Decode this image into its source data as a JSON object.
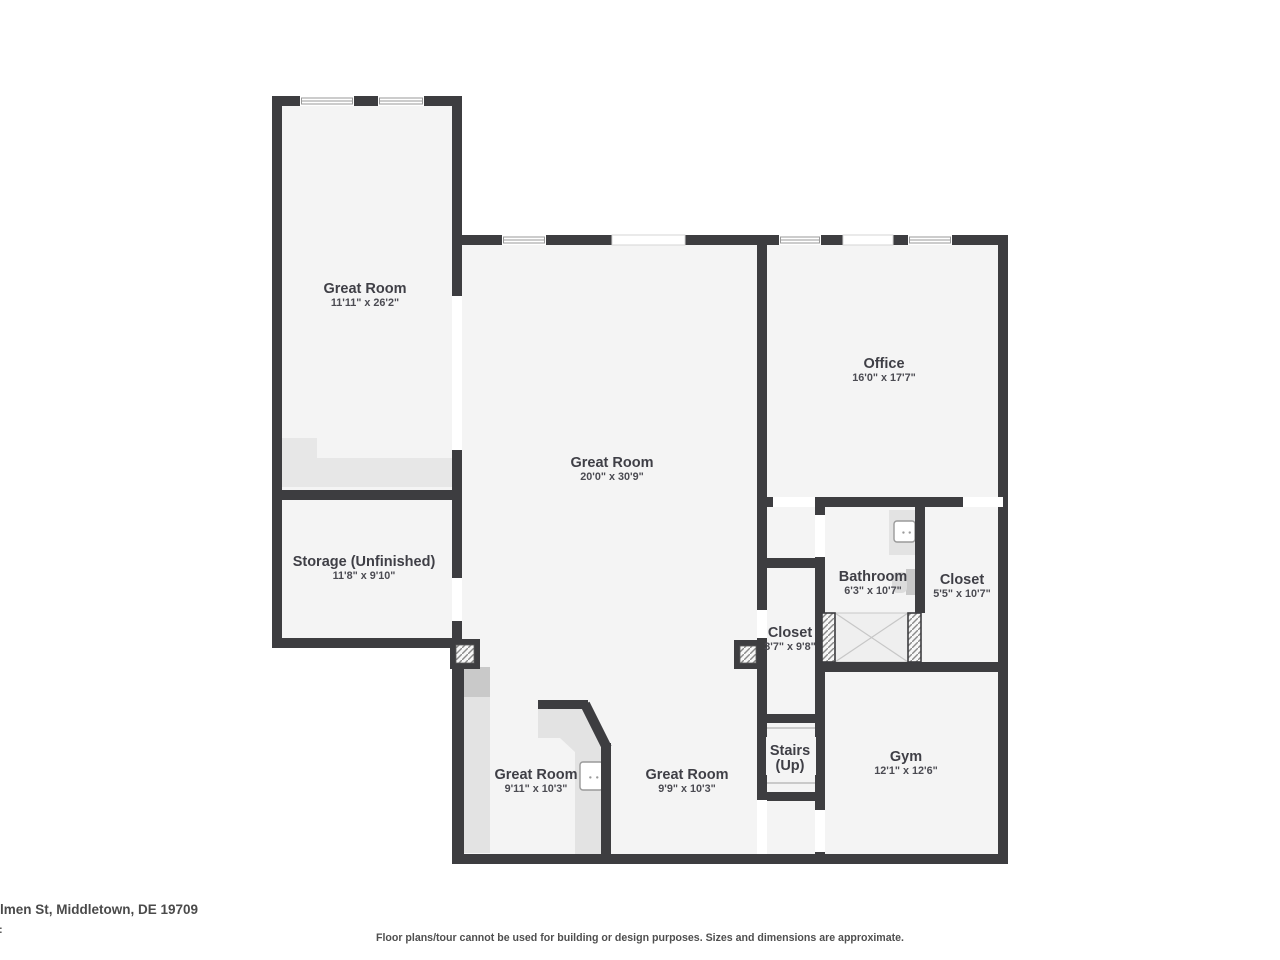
{
  "footer": {
    "address": "lmen St, Middletown, DE 19709",
    "fragment": ":",
    "disclaimer": "Floor plans/tour cannot be used for building or design purposes. Sizes and dimensions are approximate."
  },
  "colors": {
    "wall": "#3d3d40",
    "floor": "#f4f4f4",
    "zone": "#e7e7e7",
    "counter": "#e3e3e3",
    "appliance": "#c9c9c9",
    "fixture_border": "#9a9a9a",
    "shower_fill": "#efefef",
    "shower_line": "#c7c7c7",
    "tread": "#bcbcbc",
    "hatch_line": "#8a8a8a",
    "open_border": "#d6d6d6",
    "window_border": "#9a9a9a",
    "toilet_tank": "#c9c9c9",
    "toilet_bowl": "#dcdcdc"
  },
  "plan": {
    "floors": [
      [
        272,
        96,
        190,
        551
      ],
      [
        455,
        235,
        553,
        629
      ]
    ],
    "gray_zones": [
      {
        "rect": [
          277,
          438,
          40,
          49
        ],
        "fill": "zone",
        "name": "understairs-area"
      },
      {
        "rect": [
          277,
          458,
          176,
          29
        ],
        "fill": "zone",
        "name": "understairs-area"
      },
      {
        "rect": [
          462,
          697,
          28,
          156
        ],
        "fill": "counter",
        "name": "counter-left"
      },
      {
        "rect": [
          460,
          667,
          30,
          30
        ],
        "fill": "appliance",
        "name": "appliance"
      },
      {
        "rect": [
          889,
          510,
          28,
          45
        ],
        "fill": "counter",
        "name": "bathroom-vanity"
      },
      {
        "rect": [
          577,
          797,
          26,
          27
        ],
        "fill": "appliance",
        "name": "dishwasher"
      }
    ],
    "counter_polygon": "538,709 585,709 603,743 603,855 575,855 575,752 560,738 538,738",
    "walls": [
      [
        272,
        96,
        190,
        10
      ],
      [
        272,
        96,
        10,
        551
      ],
      [
        452,
        96,
        10,
        200
      ],
      [
        452,
        450,
        10,
        128
      ],
      [
        452,
        621,
        10,
        30
      ],
      [
        272,
        490,
        190,
        10
      ],
      [
        272,
        638,
        190,
        10
      ],
      [
        452,
        647,
        12,
        217
      ],
      [
        455,
        235,
        553,
        10
      ],
      [
        998,
        235,
        10,
        629
      ],
      [
        455,
        854,
        553,
        10
      ],
      [
        757,
        245,
        10,
        252
      ],
      [
        757,
        497,
        251,
        10
      ],
      [
        757,
        507,
        10,
        347
      ],
      [
        815,
        502,
        10,
        111
      ],
      [
        757,
        558,
        68,
        10
      ],
      [
        757,
        714,
        65,
        9
      ],
      [
        757,
        792,
        65,
        9
      ],
      [
        815,
        613,
        10,
        251
      ],
      [
        915,
        507,
        10,
        106
      ],
      [
        815,
        662,
        193,
        10
      ],
      [
        538,
        700,
        50,
        9
      ],
      [
        601,
        743,
        10,
        121
      ]
    ],
    "diag_wall": {
      "x1": 585,
      "y1": 704,
      "x2": 607,
      "y2": 748,
      "w": 10
    },
    "gaps": [
      [
        452,
        296,
        10,
        154
      ],
      [
        452,
        578,
        10,
        43
      ],
      [
        773,
        497,
        42,
        10
      ],
      [
        963,
        497,
        40,
        10
      ],
      [
        815,
        515,
        10,
        42
      ],
      [
        757,
        610,
        10,
        28
      ],
      [
        757,
        800,
        10,
        54
      ],
      [
        815,
        810,
        10,
        42
      ]
    ],
    "openings": [
      [
        612,
        235,
        73,
        10
      ],
      [
        843,
        235,
        50,
        10
      ]
    ],
    "windows": [
      [
        300,
        96,
        54,
        10
      ],
      [
        378,
        96,
        46,
        10
      ],
      [
        502,
        235,
        44,
        10
      ],
      [
        779,
        235,
        42,
        10
      ],
      [
        908,
        235,
        44,
        10
      ]
    ],
    "hatch_boxes": [
      {
        "frame": [
          450,
          639,
          30,
          30
        ],
        "hatch": [
          456,
          645,
          18,
          18
        ]
      },
      {
        "frame": [
          734,
          640,
          28,
          29
        ],
        "hatch": [
          740,
          646,
          16,
          17
        ]
      }
    ],
    "jamb_hatches": [
      [
        822,
        613,
        13,
        49
      ],
      [
        908,
        613,
        13,
        49
      ]
    ],
    "shower": {
      "rect": [
        835,
        613,
        73,
        49
      ]
    },
    "stairs": {
      "x": 767,
      "w": 48,
      "treads": [
        728,
        739,
        750,
        761,
        772,
        783
      ],
      "label_bg": [
        766,
        737,
        50,
        38
      ]
    },
    "sinks": [
      {
        "rect": [
          894,
          521,
          21,
          21
        ],
        "name": "bathroom-sink"
      },
      {
        "rect": [
          580,
          762,
          23,
          28
        ],
        "name": "kitchen-sink"
      }
    ],
    "toilet": {
      "tank": [
        906,
        569,
        11,
        26
      ],
      "bowl": [
        892,
        572,
        15,
        21
      ]
    },
    "rooms": [
      {
        "name": "Great Room",
        "dims": "11'11\" x 26'2\"",
        "cx": 365,
        "cy": 293
      },
      {
        "name": "Great Room",
        "dims": "20'0\" x 30'9\"",
        "cx": 612,
        "cy": 467
      },
      {
        "name": "Office",
        "dims": "16'0\" x 17'7\"",
        "cx": 884,
        "cy": 368
      },
      {
        "name": "Storage (Unfinished)",
        "dims": "11'8\" x 9'10\"",
        "cx": 364,
        "cy": 566
      },
      {
        "name": "Bathroom",
        "dims": "6'3\" x 10'7\"",
        "cx": 873,
        "cy": 581
      },
      {
        "name": "Closet",
        "dims": "5'5\" x 10'7\"",
        "cx": 962,
        "cy": 584
      },
      {
        "name": "Closet",
        "dims": "3'7\" x 9'8\"",
        "cx": 790,
        "cy": 637
      },
      {
        "name": "Stairs",
        "line2": "(Up)",
        "cx": 790,
        "cy": 755
      },
      {
        "name": "Gym",
        "dims": "12'1\" x 12'6\"",
        "cx": 906,
        "cy": 761
      },
      {
        "name": "Great Room",
        "dims": "9'11\" x 10'3\"",
        "cx": 536,
        "cy": 779
      },
      {
        "name": "Great Room",
        "dims": "9'9\" x 10'3\"",
        "cx": 687,
        "cy": 779
      }
    ]
  }
}
